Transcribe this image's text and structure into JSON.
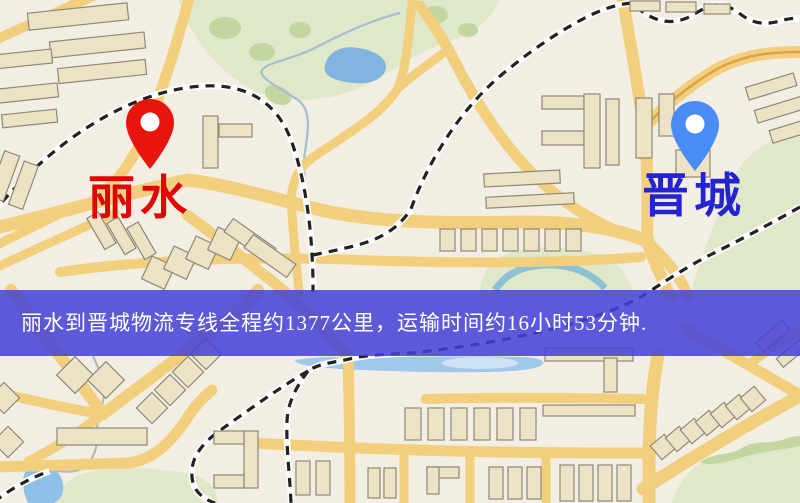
{
  "map": {
    "origin_marker": {
      "label": "丽水",
      "pin_color": "#e8150d",
      "label_color": "#e30505"
    },
    "destination_marker": {
      "label": "晋城",
      "pin_color": "#4a8cf5",
      "label_color": "#2323cf"
    },
    "banner": {
      "text": "丽水到晋城物流专线全程约1377公里，运输时间约16小时53分钟.",
      "background": "#4441d7",
      "text_color": "#ffffff",
      "route": {
        "origin": "丽水",
        "destination": "晋城",
        "distance_km": "1377",
        "duration_hours": "16",
        "duration_minutes": "53"
      }
    },
    "palette": {
      "land": "#f3eee3",
      "road": "#f2cf7d",
      "highway_centerline": "#dfa049",
      "building": "#ece3c6",
      "water": "#8fc0e8",
      "park": "#dfe8c8",
      "park_dark": "#c3d6a0",
      "railway_dash": "#222222",
      "stream": "#a4bed2"
    }
  }
}
